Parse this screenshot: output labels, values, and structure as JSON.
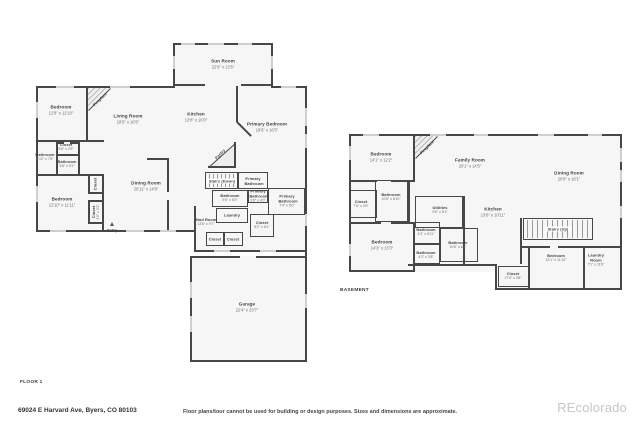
{
  "floor1": {
    "title": "FLOOR 1",
    "fireplace": "Fireplace",
    "pantry": "Pantry",
    "rooms": [
      {
        "name": "Sun Room",
        "dims": "22'9\" x 13'5\""
      },
      {
        "name": "Bedroom",
        "dims": "12'8\" x 12'10\""
      },
      {
        "name": "Living Room",
        "dims": "18'5\" x 16'5\""
      },
      {
        "name": "Kitchen",
        "dims": "13'8\" x 16'0\""
      },
      {
        "name": "Primary Bedroom",
        "dims": "19'6\" x 16'5\""
      },
      {
        "name": "Closet",
        "dims": "5'8\" x 2'5\""
      },
      {
        "name": "Bathroom",
        "dims": "5'10\" x 7'8\""
      },
      {
        "name": "Bathroom",
        "dims": "5'8\" x 5'1\""
      },
      {
        "name": "Bedroom",
        "dims": "12'10\" x 11'11\""
      },
      {
        "name": "Closet",
        "dims": ""
      },
      {
        "name": "Closet",
        "dims": "4'0\" x 2'2\""
      },
      {
        "name": "Dining Room",
        "dims": "20'11\" x 14'8\""
      },
      {
        "name": "Stairs (Down)",
        "dims": ""
      },
      {
        "name": "Primary Bathroom",
        "dims": ""
      },
      {
        "name": "Bathroom",
        "dims": "9'6\" x 6'0\""
      },
      {
        "name": "Primary Bathroom",
        "dims": "9'6\" x 4'0\""
      },
      {
        "name": "Primary Bathroom",
        "dims": "7'4\" x 8'0\""
      },
      {
        "name": "Laundry",
        "dims": ""
      },
      {
        "name": "Mud Room",
        "dims": "13'6\" x 9'7\""
      },
      {
        "name": "Closet",
        "dims": ""
      },
      {
        "name": "Closet",
        "dims": ""
      },
      {
        "name": "Closet",
        "dims": "8'2\" x 6'1\""
      },
      {
        "name": "Garage",
        "dims": "22'4\" x 23'7\""
      },
      {
        "name": "Entry",
        "dims": ""
      }
    ]
  },
  "basement": {
    "title": "BASEMENT",
    "fireplace": "Fireplace",
    "rooms": [
      {
        "name": "Bedroom",
        "dims": "14'1\" x 12'2\""
      },
      {
        "name": "Family Room",
        "dims": "20'1\" x 14'5\""
      },
      {
        "name": "Dining Room",
        "dims": "20'8\" x 18'1\""
      },
      {
        "name": "Closet",
        "dims": "7'6\" x 3'6\""
      },
      {
        "name": "Bathroom",
        "dims": "10'8\" x 8'10\""
      },
      {
        "name": "Utilities",
        "dims": "9'6\" x 8'1\""
      },
      {
        "name": "Kitchen",
        "dims": "13'8\" x 10'11\""
      },
      {
        "name": "Stairs (Up)",
        "dims": ""
      },
      {
        "name": "Bedroom",
        "dims": "14'3\" x 13'3\""
      },
      {
        "name": "Bathroom",
        "dims": "4'2\" x 6'11\""
      },
      {
        "name": "Bathroom",
        "dims": "10'8\" x 6'3\""
      },
      {
        "name": "Bathroom",
        "dims": "4'2\" x 3'8\""
      },
      {
        "name": "Bedroom",
        "dims": "12'1\" x 11'10\""
      },
      {
        "name": "Laundry Room",
        "dims": "7'1\" x 11'8\""
      },
      {
        "name": "Closet",
        "dims": "17'0\" x 3'8\""
      }
    ]
  },
  "footer": {
    "address": "69024 E Harvard Ave, Byers, CO 80103",
    "disclaimer": "Floor plans/tour cannot be used for building or design purposes. Sizes and dimensions are approximate.",
    "watermark": "REcolorado"
  },
  "colors": {
    "wall": "#474747",
    "window": "#cfcfcf",
    "room_fill": "#f6f6f6",
    "watermark": "#c7c7c7"
  }
}
